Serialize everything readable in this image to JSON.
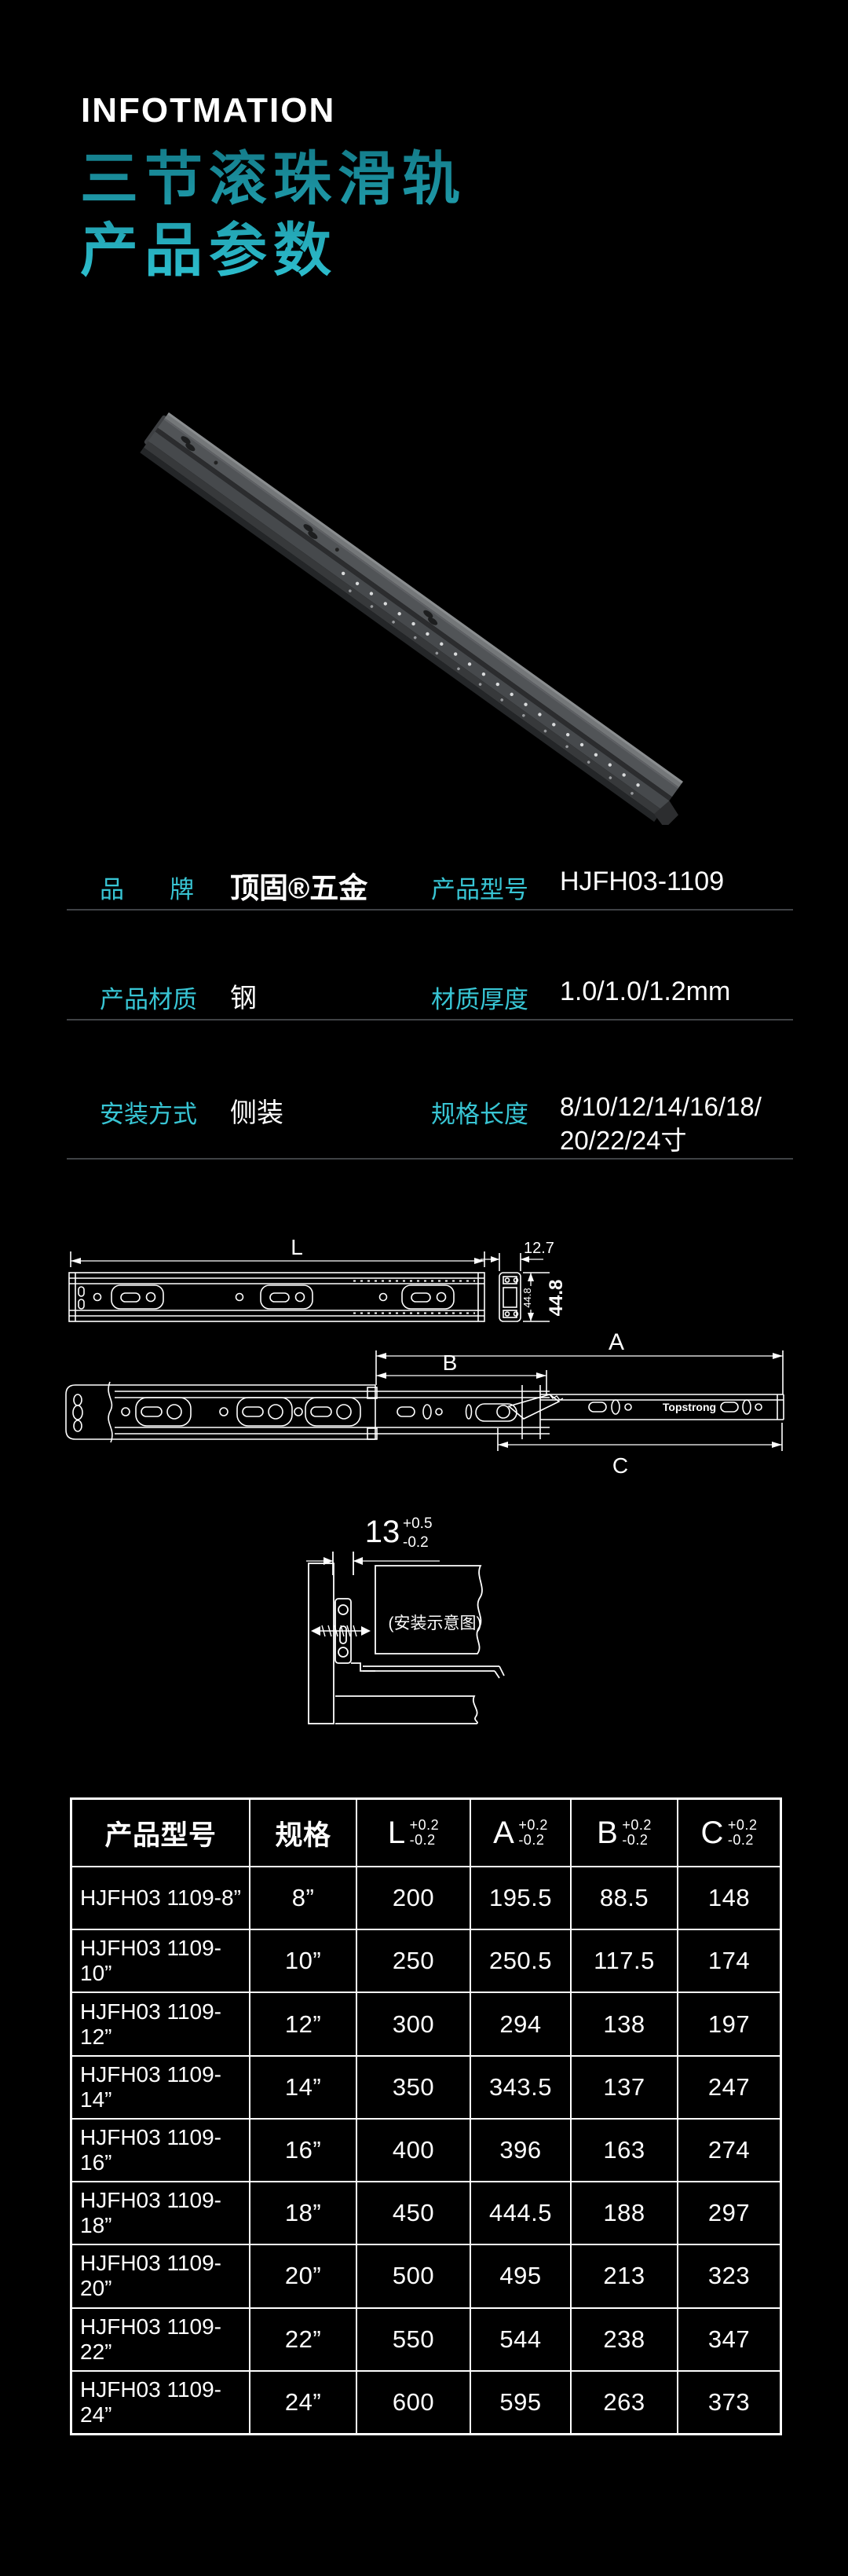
{
  "page": {
    "background": "#000000",
    "accent_teal": "#38c5d4",
    "title_gradient_start": "#137a88",
    "title_gradient_end": "#2ec2d2",
    "text_color": "#ffffff",
    "divider_color": "#3f4245"
  },
  "header": {
    "eyebrow": "INFOTMATION",
    "title_line1": "三节滚珠滑轨",
    "title_line2": "产品参数"
  },
  "specs": {
    "row1": {
      "label1": "品牌",
      "value1": "顶固®五金",
      "label2": "产品型号",
      "value2": "HJFH03-1109"
    },
    "row2": {
      "label1": "产品材质",
      "value1": "钢",
      "label2": "材质厚度",
      "value2": "1.0/1.0/1.2mm"
    },
    "row3": {
      "label1": "安装方式",
      "value1": "侧装",
      "label2": "规格长度",
      "value2_line1": "8/10/12/14/16/18/",
      "value2_line2": "20/22/24寸"
    }
  },
  "drawings": {
    "dim_length": "L",
    "dim_width": "12.7",
    "dim_height_small": "44.8",
    "dim_height_big": "44.8",
    "dim_a": "A",
    "dim_b": "B",
    "dim_c": "C",
    "dim_offset": "13",
    "dim_offset_tol_plus": "+0.5",
    "dim_offset_tol_minus": "-0.2",
    "install_caption": "(安装示意图)",
    "rail_brand": "Topstrong"
  },
  "table": {
    "col_model": "产品型号",
    "col_spec": "规格",
    "dim_cols": [
      {
        "letter": "L",
        "tol_plus": "+0.2",
        "tol_minus": "-0.2"
      },
      {
        "letter": "A",
        "tol_plus": "+0.2",
        "tol_minus": "-0.2"
      },
      {
        "letter": "B",
        "tol_plus": "+0.2",
        "tol_minus": "-0.2"
      },
      {
        "letter": "C",
        "tol_plus": "+0.2",
        "tol_minus": "-0.2"
      }
    ],
    "rows": [
      {
        "model": "HJFH03 1109-8”",
        "spec": "8”",
        "L": "200",
        "A": "195.5",
        "B": "88.5",
        "C": "148"
      },
      {
        "model": "HJFH03 1109-10”",
        "spec": "10”",
        "L": "250",
        "A": "250.5",
        "B": "117.5",
        "C": "174"
      },
      {
        "model": "HJFH03 1109-12”",
        "spec": "12”",
        "L": "300",
        "A": "294",
        "B": "138",
        "C": "197"
      },
      {
        "model": "HJFH03 1109-14”",
        "spec": "14”",
        "L": "350",
        "A": "343.5",
        "B": "137",
        "C": "247"
      },
      {
        "model": "HJFH03 1109-16”",
        "spec": "16”",
        "L": "400",
        "A": "396",
        "B": "163",
        "C": "274"
      },
      {
        "model": "HJFH03 1109-18”",
        "spec": "18”",
        "L": "450",
        "A": "444.5",
        "B": "188",
        "C": "297"
      },
      {
        "model": "HJFH03 1109-20”",
        "spec": "20”",
        "L": "500",
        "A": "495",
        "B": "213",
        "C": "323"
      },
      {
        "model": "HJFH03 1109-22”",
        "spec": "22”",
        "L": "550",
        "A": "544",
        "B": "238",
        "C": "347"
      },
      {
        "model": "HJFH03 1109-24”",
        "spec": "24”",
        "L": "600",
        "A": "595",
        "B": "263",
        "C": "373"
      }
    ]
  }
}
